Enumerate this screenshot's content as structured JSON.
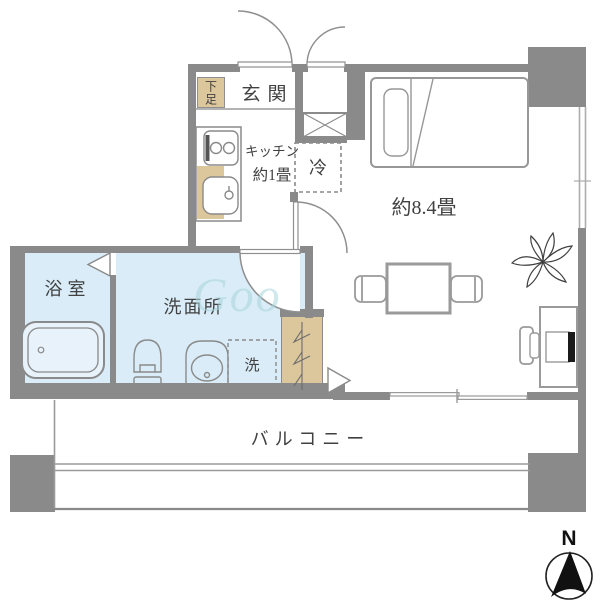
{
  "title": "apartment-floor-plan",
  "rooms": {
    "genkan": {
      "label": "玄関"
    },
    "shoe_box": {
      "label": "下足"
    },
    "kitchen": {
      "line1": "キッチン",
      "line2": "約1畳"
    },
    "fridge": {
      "label": "冷"
    },
    "main_room": {
      "label": "約8.4畳"
    },
    "bathroom": {
      "label": "浴室"
    },
    "washroom": {
      "label": "洗面所"
    },
    "laundry": {
      "label": "洗"
    },
    "balcony": {
      "label": "バルコニー"
    }
  },
  "compass": {
    "north_label": "N"
  },
  "watermark": {
    "text": "Goo"
  },
  "colors": {
    "wall": "#8a8a8a",
    "wet_room_fill": "#d9ecf7",
    "wood_fill": "#dcc79d",
    "furniture_line": "#9a9a9a",
    "fixture_line": "#8a8a8a",
    "label_text": "#414141",
    "watermark_text": "#a9d6dc"
  }
}
